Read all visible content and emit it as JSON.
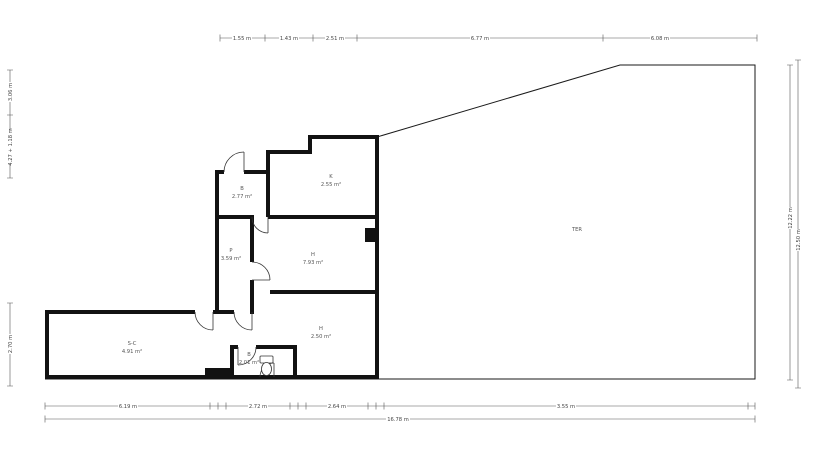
{
  "plan": {
    "title": "apartment-floor-plan",
    "rooms": [
      {
        "label": "B",
        "area": "2.77 m²"
      },
      {
        "label": "K",
        "area": "2.55 m²"
      },
      {
        "label": "P",
        "area": "3.59 m²"
      },
      {
        "label": "H",
        "area": "7.93 m²"
      },
      {
        "label": "H",
        "area": "2.50 m²"
      },
      {
        "label": "S-C",
        "area": "4.91 m²"
      },
      {
        "label": "B",
        "area": "2.01 m²"
      },
      {
        "label": "TER",
        "area": ""
      }
    ]
  },
  "dims": {
    "top": [
      "1.55 m",
      "1.43 m",
      "2.51 m",
      "6.77 m",
      "6.08 m"
    ],
    "bottom": [
      "6.19 m",
      "2.72 m",
      "2.64 m",
      "3.55 m"
    ],
    "bottom_total": "16.78 m",
    "left_upper": [
      "3.06 m",
      "4.27 + 1.18 m"
    ],
    "left_lower": "2.70 m",
    "right": [
      "12.22 m",
      "12.50 m"
    ]
  },
  "colors": {
    "wall": "#121212",
    "outline": "#1a1a1a",
    "dim_line": "#555555",
    "label_text": "#444444"
  }
}
